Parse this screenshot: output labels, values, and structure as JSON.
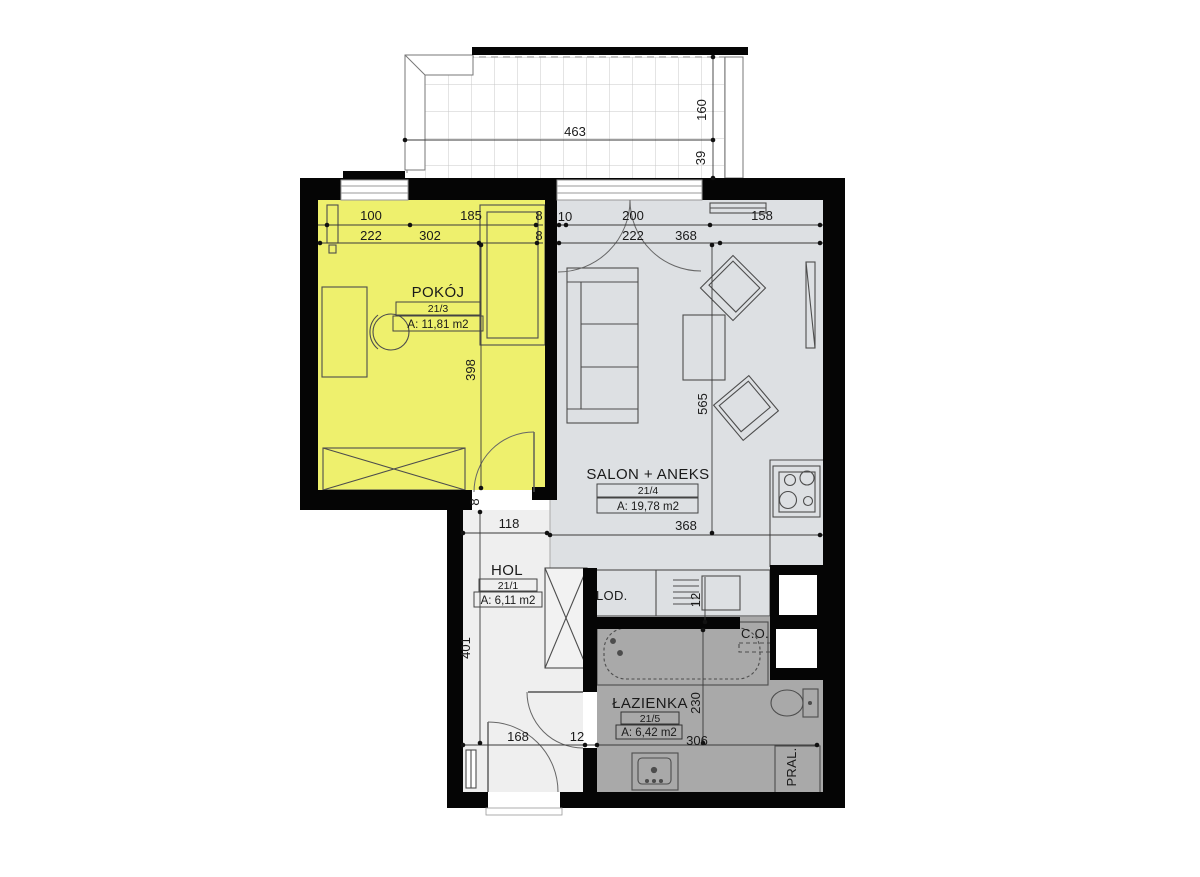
{
  "plan": {
    "rooms": {
      "pokoj": {
        "name": "POKÓJ",
        "number": "21/3",
        "area": "A: 11,81 m2"
      },
      "salon": {
        "name": "SALON + ANEKS",
        "number": "21/4",
        "area": "A: 19,78 m2"
      },
      "hol": {
        "name": "HOL",
        "number": "21/1",
        "area": "A: 6,11 m2"
      },
      "lazienka": {
        "name": "ŁAZIENKA",
        "number": "21/5",
        "area": "A: 6,42 m2"
      }
    },
    "fixtures": {
      "fridge": "LOD.",
      "heating": "C.O.",
      "washer": "PRAL."
    },
    "dims": {
      "d463": "463",
      "d160": "160",
      "d39": "39",
      "p100": "100",
      "p222": "222",
      "p185": "185",
      "p8a": "8",
      "p302": "302",
      "p8b": "8",
      "s10": "10",
      "s200": "200",
      "s158": "158",
      "s222": "222",
      "s368": "368",
      "v398": "398",
      "v565": "565",
      "d8c": "8",
      "d118": "118",
      "s368b": "368",
      "v12a": "12",
      "v401": "401",
      "v230": "230",
      "b168": "168",
      "b12": "12",
      "b306": "306"
    },
    "colors": {
      "pokoj": "#eef06d",
      "salon": "#dde0e3",
      "hol": "#efefef",
      "lazienka": "#a9a9a9",
      "wall": "#050505"
    }
  }
}
